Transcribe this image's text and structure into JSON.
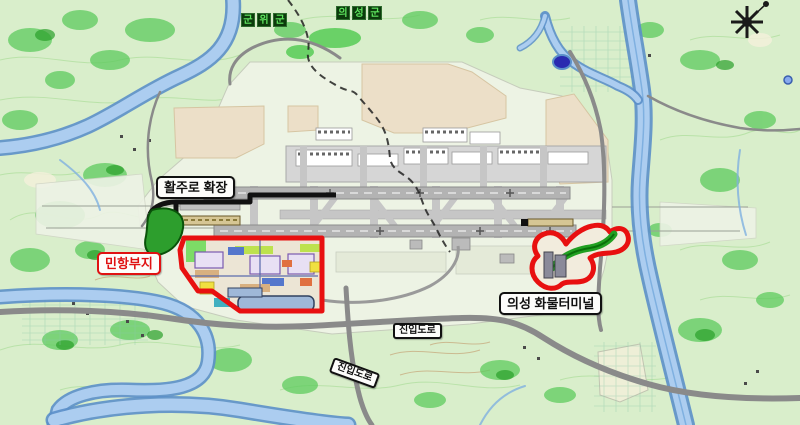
{
  "map": {
    "labels": {
      "gunwi": {
        "text": "군위군",
        "chars": [
          "군",
          "위",
          "군"
        ]
      },
      "uiseong": {
        "text": "의성군",
        "chars": [
          "의",
          "성",
          "군"
        ]
      },
      "runway_extension": "활주로 확장",
      "civil_site": "민항부지",
      "cargo_terminal": "의성 화물터미널",
      "access_road_a": "진입도로",
      "access_road_b": "진입도로"
    },
    "icons": {
      "compass": "compass-rose-icon"
    },
    "colors": {
      "terrain_green": "#d9eecb",
      "forest_green": "#5ecb5e",
      "contour_green": "#a8dc96",
      "river_edge_blue": "#5b8fc9",
      "river_fill_blue": "#accdf0",
      "road_gray": "#8a8a8a",
      "runway_gray": "#b3b3b3",
      "platform_pale": "#edf3e4",
      "cut_area_beige": "#ecdfc8",
      "civil_site_outline_red": "#e81010",
      "runway_extension_outline_black": "#111111",
      "green_zone": "#2d9e2d",
      "admin_label_bg": "#0c3b0c",
      "admin_label_text": "#5fe45f"
    }
  }
}
